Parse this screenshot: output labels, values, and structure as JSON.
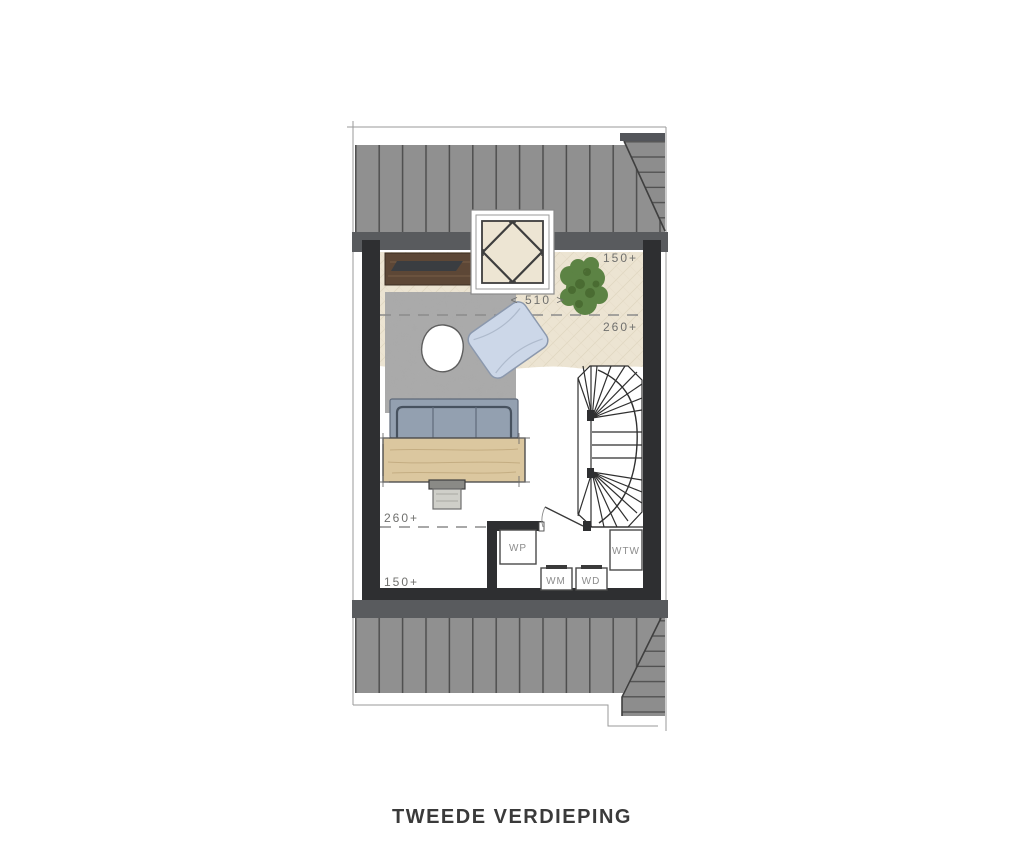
{
  "title": "TWEEDE VERDIEPING",
  "plan": {
    "labels": {
      "top_height": "150+",
      "width": "< 510 >",
      "upper_height": "260+",
      "lower_height": "260+",
      "bottom_height": "150+"
    },
    "equipment": {
      "wp": "WP",
      "wtw": "WTW",
      "wm": "WM",
      "wd": "WD"
    },
    "colors": {
      "wall": "#2e2f31",
      "eave": "#595b5e",
      "roof": "#909090",
      "roof_seam": "#4e4e4e",
      "attic_floor": "#ece4d2",
      "rug": "#a9a9a9",
      "sofa": "#93a0b0",
      "table": "#dbc79f",
      "cabinet": "#5d4736",
      "plant": "#5c8344",
      "pillow": "#ccd7e8"
    }
  }
}
